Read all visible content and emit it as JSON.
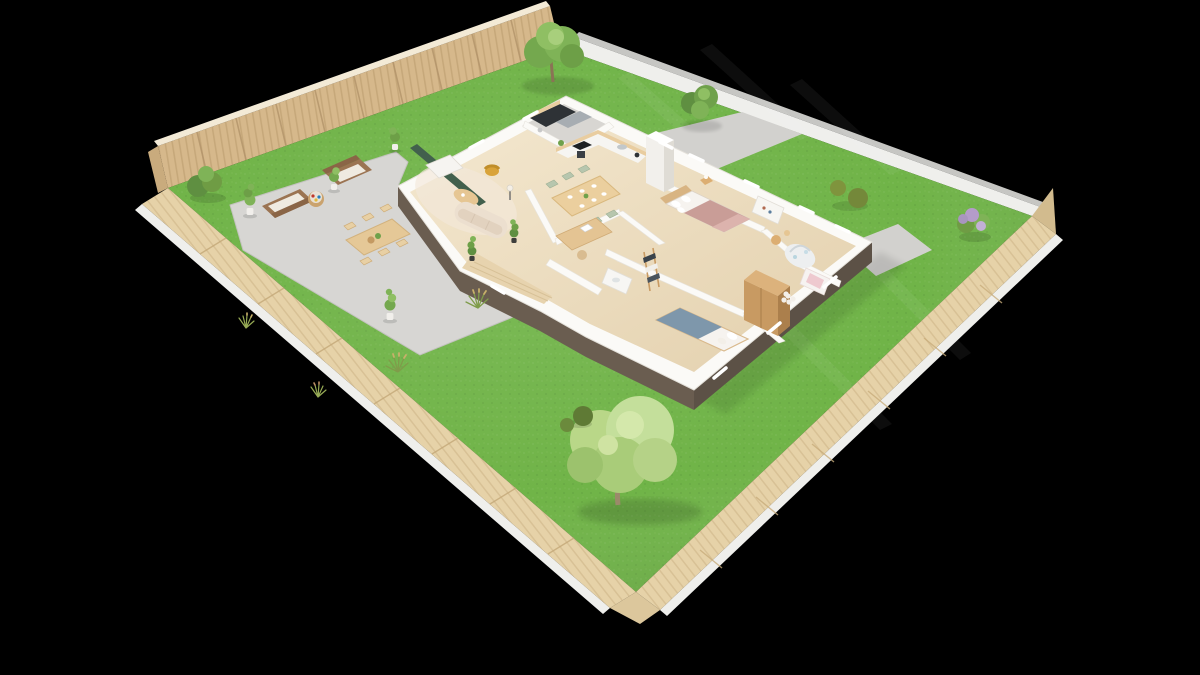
{
  "canvas": {
    "background": "#000000"
  },
  "palette": {
    "grass": "#6db244",
    "grassDark": "#56933a",
    "grassLight": "#86c658",
    "curb": "#efefec",
    "curbGray": "#c6c6c3",
    "fenceInner": "#d6b88b",
    "fenceInnerDark": "#bd9e6f",
    "fenceOuter": "#e6d2a8",
    "fenceOuterDark": "#d2bb8e",
    "fenceRail": "#f3ead6",
    "patio": "#d7d6d3",
    "patioEdge": "#c3c2bf",
    "driveway": "#d2d1ce",
    "wallWhite": "#fbfaf7",
    "wallShade": "#eeebe5",
    "plinth": "#6a5d50",
    "plinthDark": "#5c5146",
    "floorWood": "#ecdbbc",
    "floorGarage": "#d8d6d2",
    "greenWall": "#42604d",
    "console": "#f6f4f1",
    "mustard": "#d9a339",
    "sofaCream": "#ecdfcf",
    "woodLight": "#e9cda0",
    "woodMid": "#d3a96e",
    "woodDark": "#9b7452",
    "sage": "#b7c6ae",
    "deskWood": "#e4c493",
    "bedMauve": "#c99d97",
    "pillow": "#f6f3ef",
    "blanketBlue": "#7e97ab",
    "wardrobe": "#c89a62",
    "wardrobeTop": "#dcb27c",
    "wardrobeSide": "#ab7f4c",
    "matGray": "#edeff0",
    "babyBlue": "#b9d5df",
    "pinkCloset": "#eec9cf",
    "towelDark": "#3a434b",
    "applianceDark": "#2e3236",
    "steel": "#a7adb2",
    "treeGreen": "#7fb357",
    "treeDark": "#5f8f41",
    "treeLight": "#a8cf7c",
    "treeLime": "#c4df9b",
    "olive": "#7f943d",
    "lilac": "#b49cc9",
    "potWhite": "#f1efeb",
    "trunk": "#8a7355"
  },
  "scene": {
    "type": "3d-floor-plan-render",
    "view": "isometric-dollhouse-cutaway",
    "lot": {
      "boundary": "wooden-slat-privacy-fence",
      "open_side_edge": "white-curb-sidewalk",
      "ground": "lawn-grass",
      "hardscape": [
        "patio",
        "driveway",
        "rear-walkway",
        "side-path"
      ]
    },
    "house": {
      "style": "single-storey-cutaway-walls",
      "base": "dark-plinth-foundation",
      "rooms": [
        {
          "name": "garage-workshop",
          "floor": "concrete-gray",
          "furniture": [
            "workbench-dark",
            "steel-tool-shelf"
          ]
        },
        {
          "name": "kitchen",
          "furniture": [
            "l-shaped-counter",
            "black-cooktop",
            "oven",
            "sink",
            "tall-cabinet-column",
            "coffee-machine",
            "potted-herb"
          ]
        },
        {
          "name": "dining-area",
          "furniture": [
            "wood-table",
            "sage-chairs",
            "tableware"
          ],
          "chair_count": 6
        },
        {
          "name": "living-room",
          "furniture": [
            "green-accent-wall",
            "tv-sideboard",
            "mustard-armchair",
            "organic-coffee-table",
            "curved-cream-sofa",
            "floor-lamp",
            "area-rug"
          ]
        },
        {
          "name": "home-office",
          "furniture": [
            "desk",
            "laptop",
            "chair"
          ]
        },
        {
          "name": "bathroom",
          "furniture": [
            "vanity-sink",
            "ladder-towel-rack"
          ]
        },
        {
          "name": "master-bedroom",
          "furniture": [
            "double-bed-mauve",
            "wood-headboard-panel",
            "nightstand",
            "table-lamp",
            "shelf-unit"
          ]
        },
        {
          "name": "kids-bedroom",
          "furniture": [
            "single-bed-blue-blanket",
            "tall-wood-wardrobe"
          ]
        },
        {
          "name": "nursery",
          "furniture": [
            "baby-play-gym",
            "play-mat",
            "kids-round-table",
            "pink-closet",
            "flower-rug"
          ]
        }
      ]
    },
    "outdoor": {
      "patio_furniture": [
        "outdoor-loveseat",
        "outdoor-loveseat",
        "round-rattan-table-with-games",
        "outdoor-dining-table",
        "folding-chairs"
      ],
      "dining_chair_count": 6,
      "plants": [
        "large-deciduous-tree-top",
        "shrub-tree-by-driveway",
        "giant-light-green-tree-bottom",
        "lilac-bush-east-corner",
        "olive-topiary-pair",
        "corner-shrub-west",
        "dark-bushes",
        "ornamental-grasses",
        "slim-potted-trees",
        "terrace-climbing-plants"
      ]
    }
  }
}
